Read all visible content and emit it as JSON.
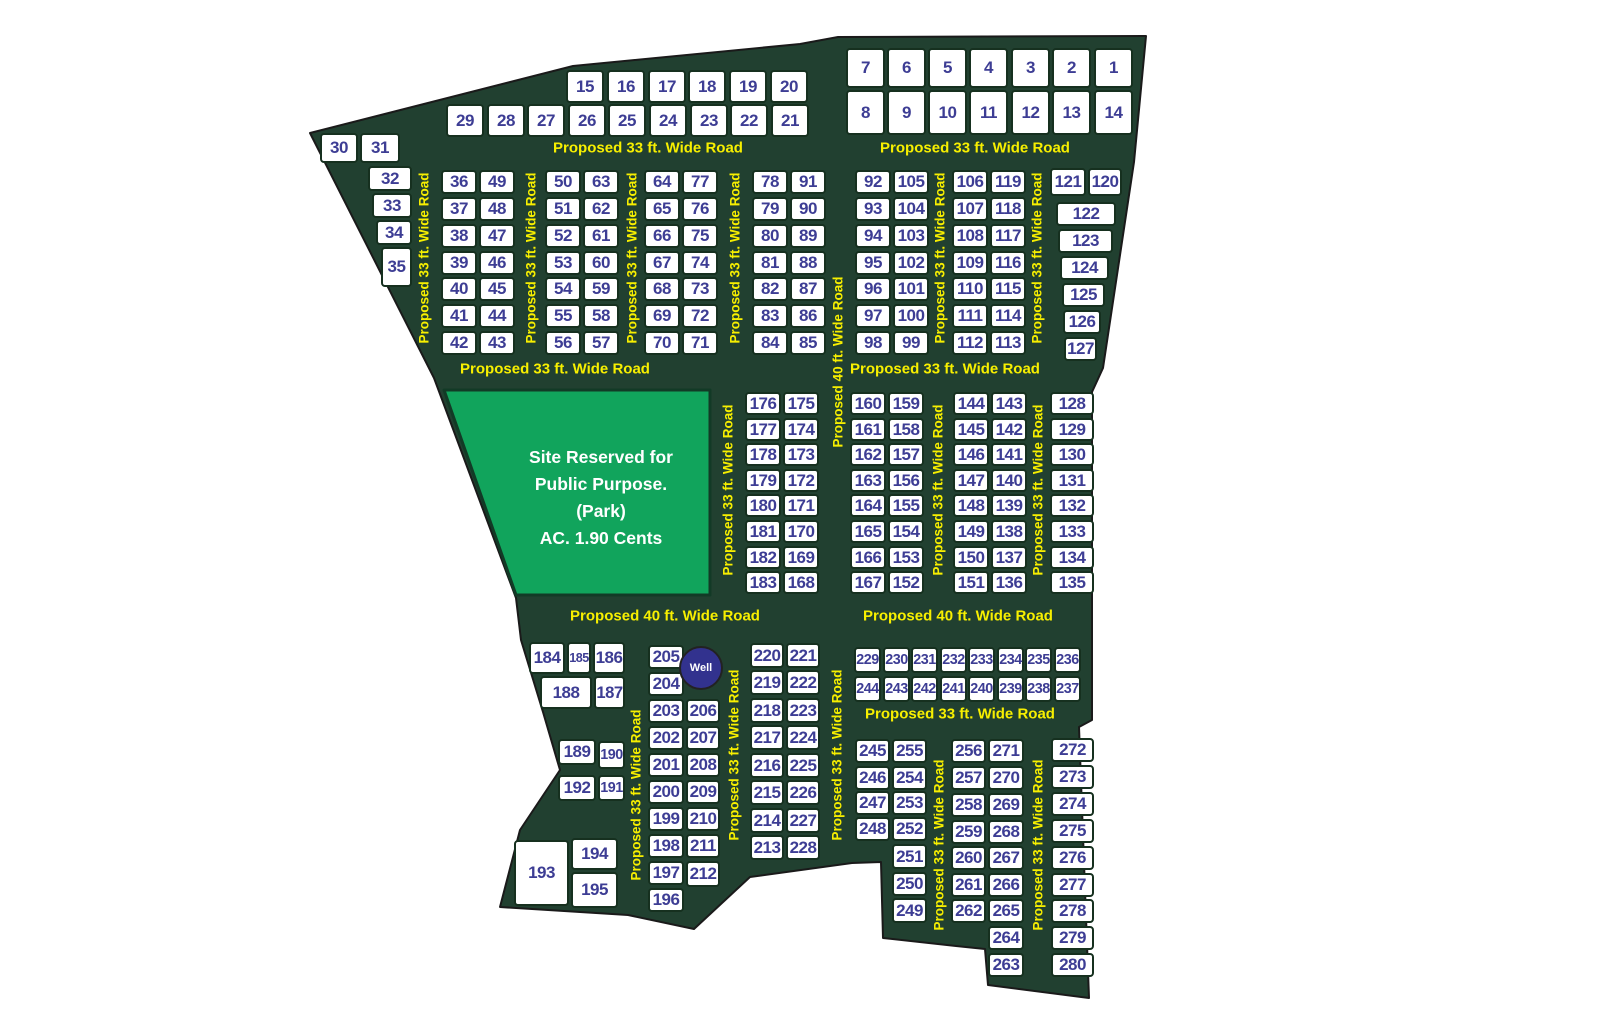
{
  "road_label_texts": {
    "w33": "Proposed 33 ft. Wide Road",
    "w40": "Proposed 40 ft. Wide Road"
  },
  "park": {
    "line1": "Site Reserved for",
    "line2": "Public Purpose.",
    "line3": "(Park)",
    "line4": "AC. 1.90 Cents"
  },
  "well": {
    "label": "Well"
  },
  "colors": {
    "road_green": "#214030",
    "park_green": "#11a45c",
    "label_yellow": "#f7ef00",
    "plot_number": "#3d3d94",
    "plot_border": "#16301f",
    "well_blue": "#32328e",
    "boundary": "#1a1a1a"
  },
  "blocks": {
    "row_15_20": [
      15,
      16,
      17,
      18,
      19,
      20
    ],
    "row_29_21": [
      29,
      28,
      27,
      26,
      25,
      24,
      23,
      22,
      21
    ],
    "row_7_1": [
      7,
      6,
      5,
      4,
      3,
      2,
      1
    ],
    "row_8_14": [
      8,
      9,
      10,
      11,
      12,
      13,
      14
    ],
    "w30": [
      30,
      31
    ],
    "w32": [
      32,
      33,
      34,
      35
    ],
    "b36": [
      36,
      49,
      37,
      48,
      38,
      47,
      39,
      46,
      40,
      45,
      41,
      44,
      42,
      43
    ],
    "b50": [
      50,
      63,
      51,
      62,
      52,
      61,
      53,
      60,
      54,
      59,
      55,
      58,
      56,
      57
    ],
    "b64": [
      64,
      77,
      65,
      76,
      66,
      75,
      67,
      74,
      68,
      73,
      69,
      72,
      70,
      71
    ],
    "b78": [
      78,
      91,
      79,
      90,
      80,
      89,
      81,
      88,
      82,
      87,
      83,
      86,
      84,
      85
    ],
    "b92": [
      92,
      105,
      93,
      104,
      94,
      103,
      95,
      102,
      96,
      101,
      97,
      100,
      98,
      99
    ],
    "b106": [
      106,
      119,
      107,
      118,
      108,
      117,
      109,
      116,
      110,
      115,
      111,
      114,
      112,
      113
    ],
    "b121": [
      121,
      120
    ],
    "b122": [
      122,
      123,
      124,
      125,
      126,
      127
    ],
    "b176": [
      176,
      175,
      177,
      174,
      178,
      173,
      179,
      172,
      180,
      171,
      181,
      170,
      182,
      169,
      183,
      168
    ],
    "b160": [
      160,
      159,
      161,
      158,
      162,
      157,
      163,
      156,
      164,
      155,
      165,
      154,
      166,
      153,
      167,
      152
    ],
    "b144": [
      144,
      143,
      145,
      142,
      146,
      141,
      147,
      140,
      148,
      139,
      149,
      138,
      150,
      137,
      151,
      136
    ],
    "b128": [
      128,
      129,
      130,
      131,
      132,
      133,
      134,
      135
    ],
    "b184": [
      184,
      185,
      186,
      188,
      187
    ],
    "b189": [
      189,
      190,
      192,
      191
    ],
    "b193": [
      193,
      194,
      195
    ],
    "b205": [
      205,
      204,
      203,
      206,
      202,
      207,
      201,
      208,
      200,
      209,
      199,
      210,
      198,
      211,
      197,
      212,
      196
    ],
    "b220": [
      220,
      221,
      219,
      222,
      218,
      223,
      217,
      224,
      216,
      225,
      215,
      226,
      214,
      227,
      213,
      228
    ],
    "b229": [
      229,
      230,
      231,
      232,
      233,
      234,
      235,
      236,
      244,
      243,
      242,
      241,
      240,
      239,
      238,
      237
    ],
    "b245": [
      245,
      255,
      246,
      254,
      247,
      253,
      248,
      252,
      251,
      250,
      249
    ],
    "b256": [
      256,
      271,
      257,
      270,
      258,
      269,
      259,
      268,
      260,
      267,
      261,
      266,
      262,
      265,
      264,
      263
    ],
    "b272": [
      272,
      273,
      274,
      275,
      276,
      277,
      278,
      279,
      280
    ]
  }
}
